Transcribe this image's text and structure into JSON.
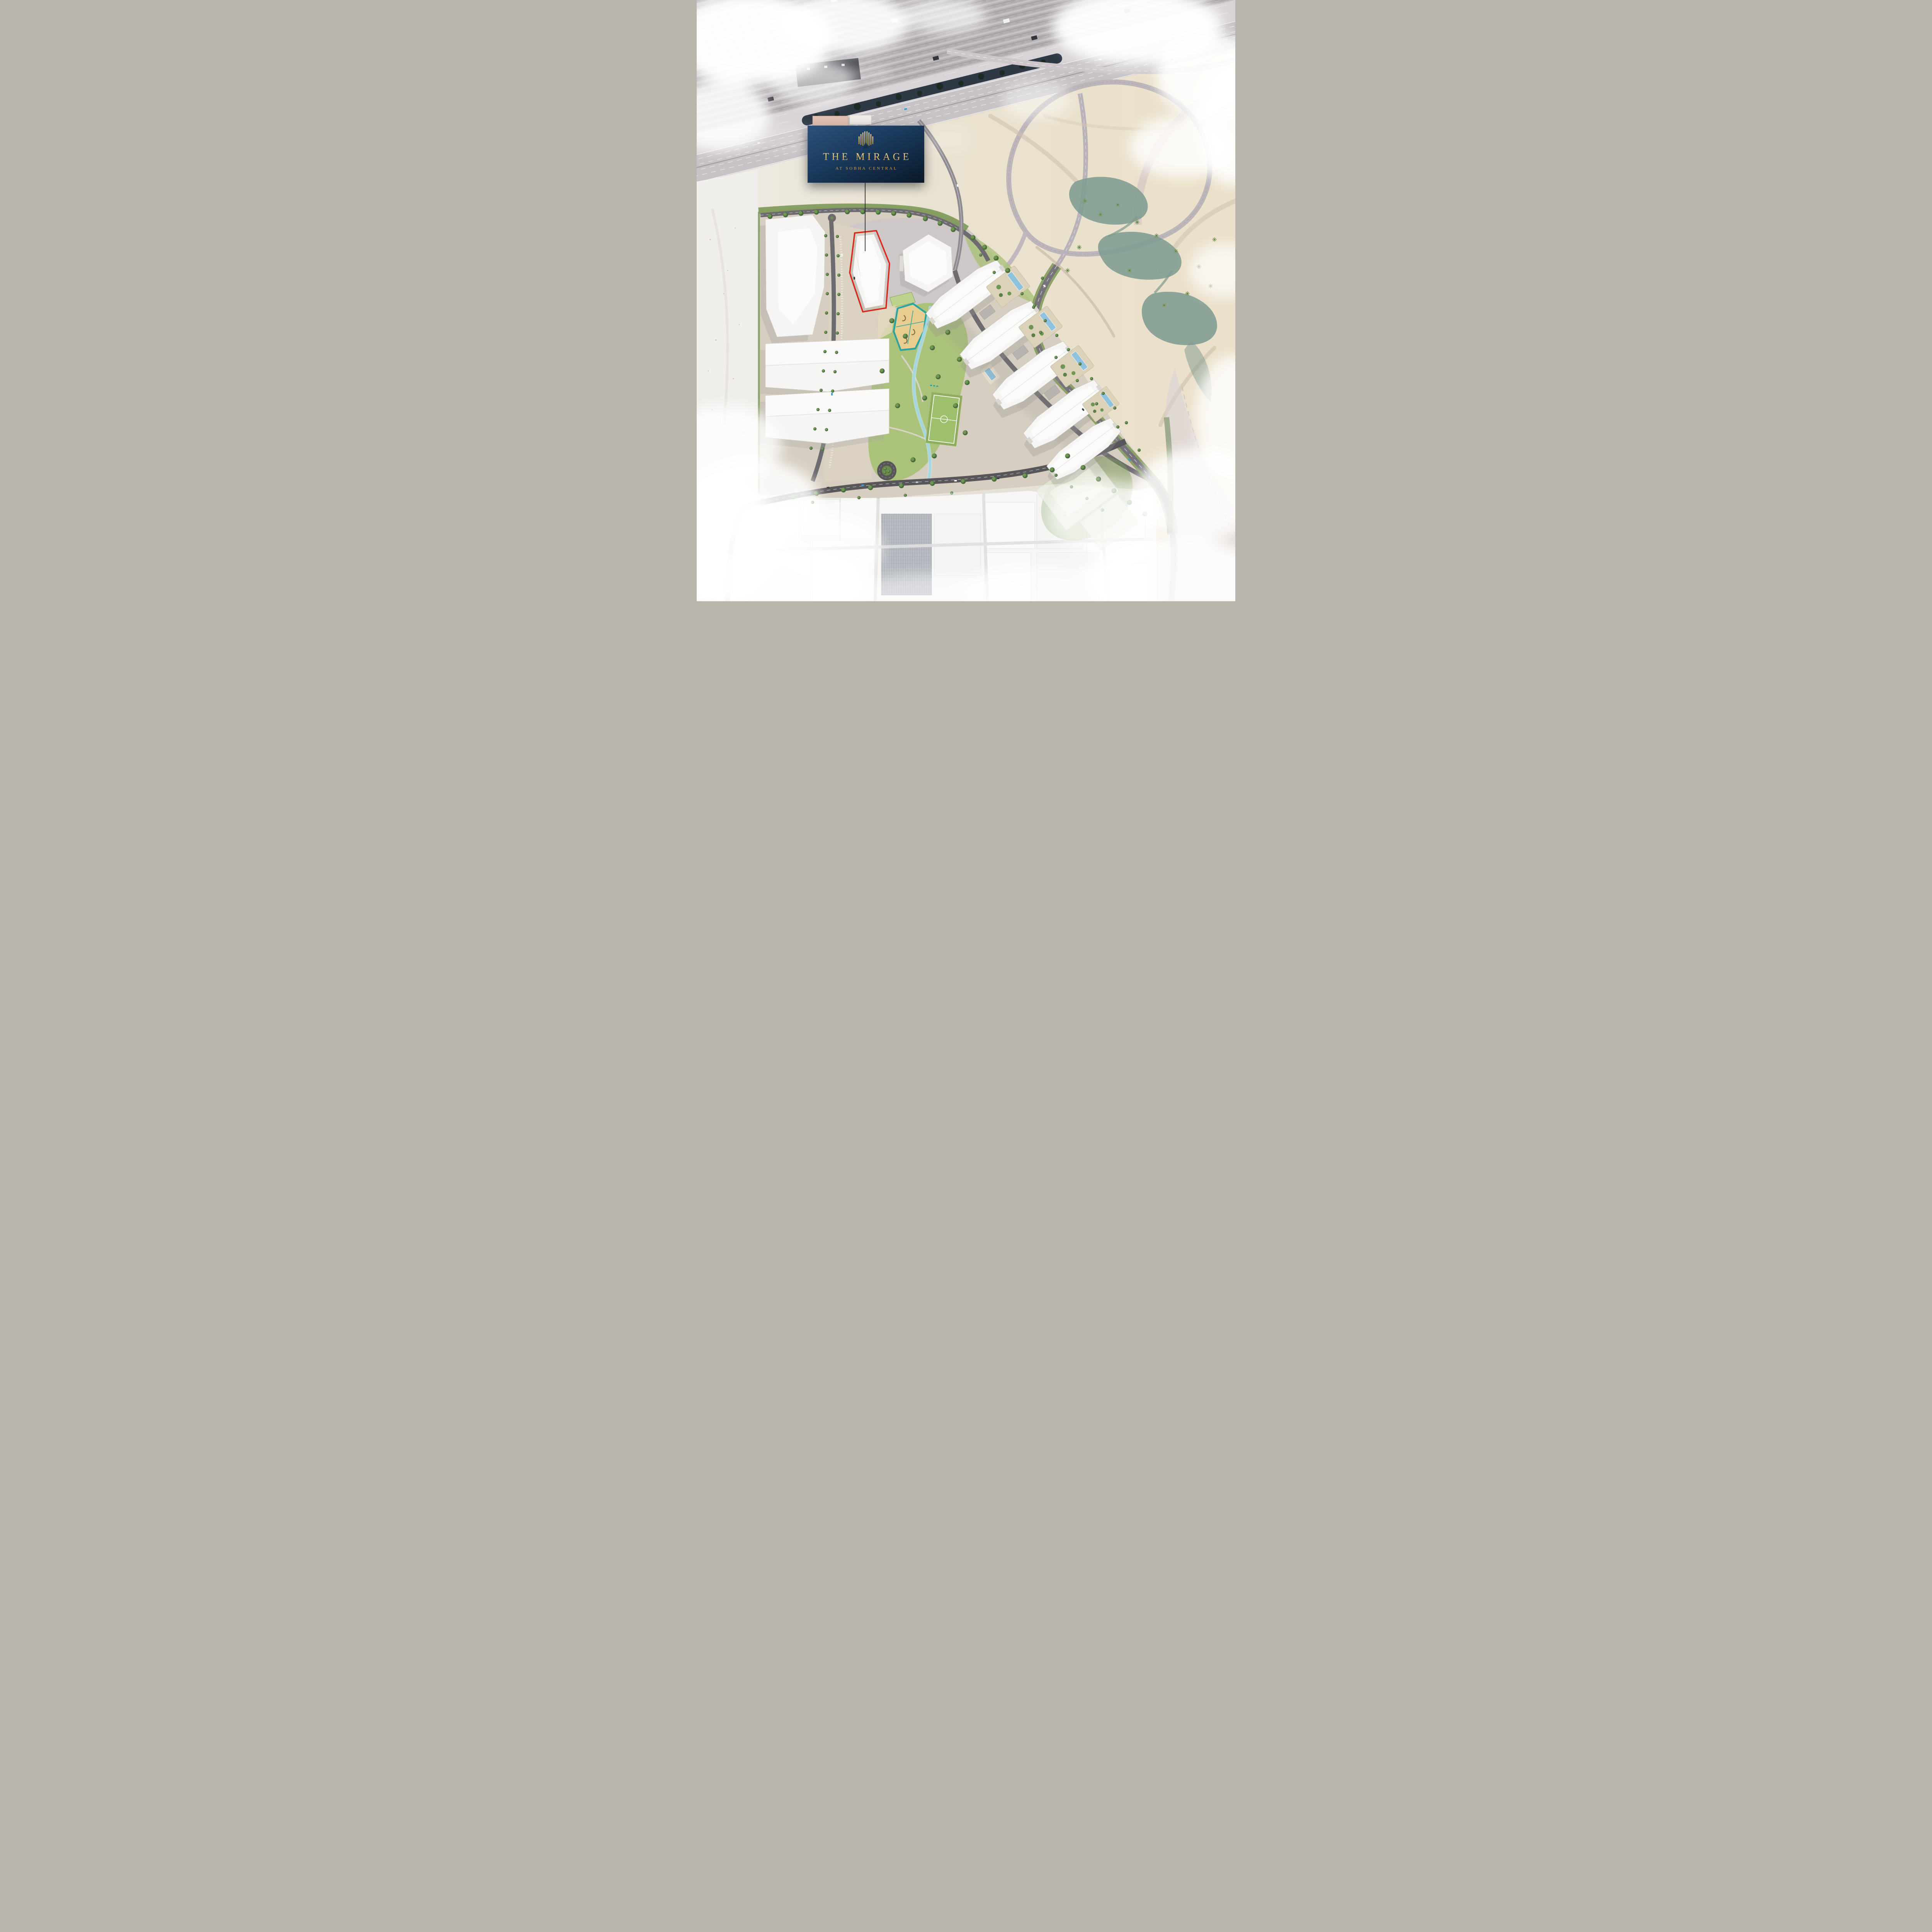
{
  "page": {
    "type": "aerial-masterplan-rendering"
  },
  "badge": {
    "logo_icon": "mirage-bars-monogram",
    "title": "THE MIRAGE",
    "subtitle": "AT SOBHA CENTRAL"
  },
  "highlight": {
    "feature": "hero-plot-red-outline",
    "color": "#d8281c",
    "leader_line": true
  },
  "colors": {
    "sand": "#ece3d0",
    "desertWhite": "#f1efec",
    "roof": "#b4afb3",
    "shoulder": "#d8d3d6",
    "highway": "#c7c2c6",
    "navyMedian": "#242f3d",
    "roadDark": "#6e6b70",
    "roadDarker": "#585659",
    "ramp": "#bfb9bd",
    "pinkRoad": "#d6c7c5",
    "verge": "#7c9857",
    "lawn": "#abc27b",
    "field": "#9ec06c",
    "water": "#7d9a8f",
    "stream": "#a3d6e0",
    "pool": "#8fc3dd",
    "pgTeal": "#2ba49f",
    "pgSand": "#e8cd90",
    "bldg": "#f6f5f3",
    "podium": "#dcd2ba",
    "accent": "#d8281c",
    "badgeTop": "#2c5179",
    "badgeBottom": "#0a1828",
    "gold": "#cfa34d",
    "goldLight": "#f0d78f",
    "industrial": "#f2f1ef",
    "cloud": "#ffffff"
  }
}
